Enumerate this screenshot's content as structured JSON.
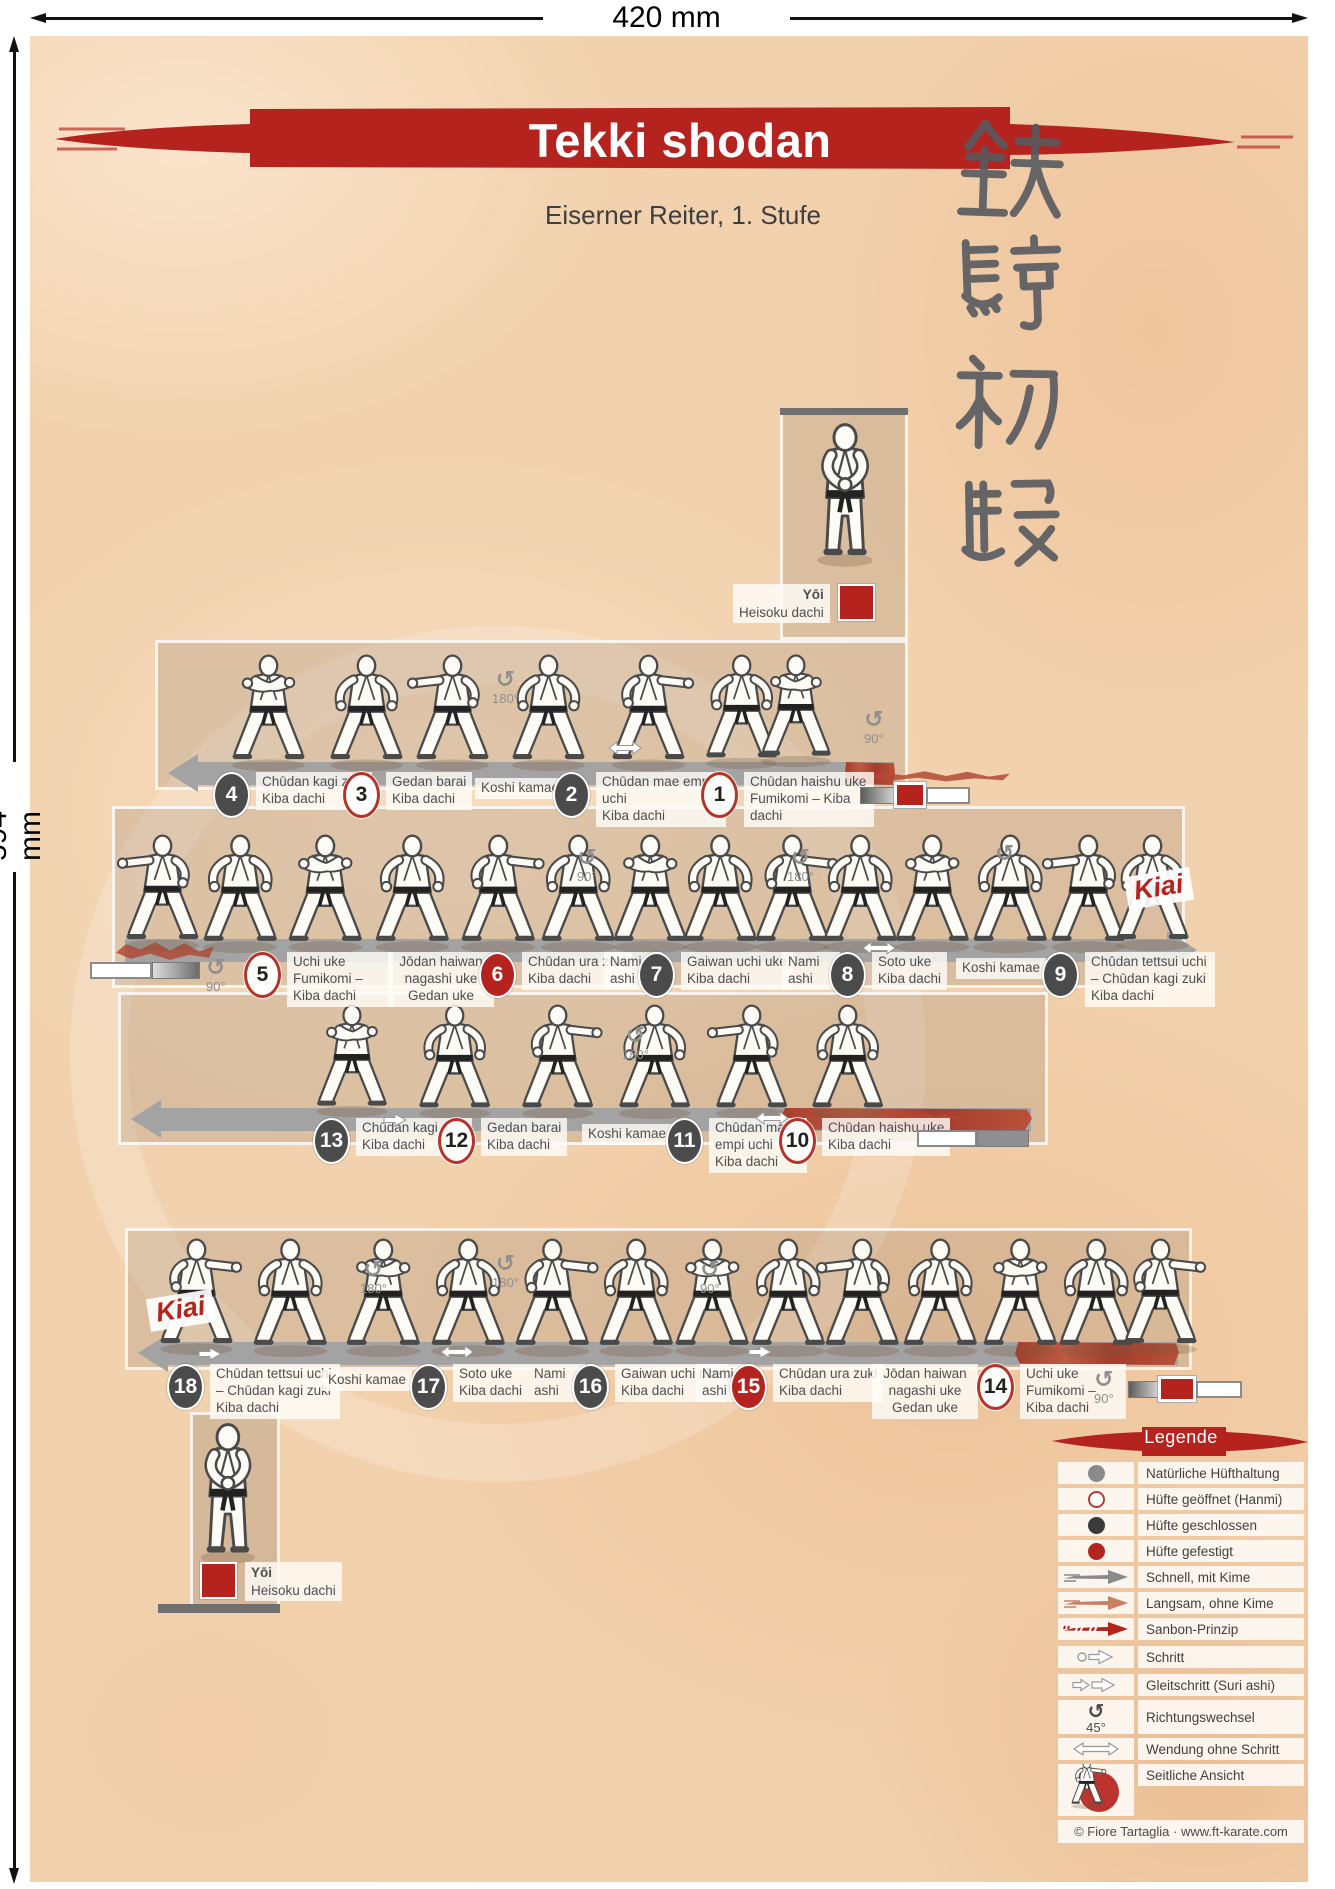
{
  "page": {
    "ruler_top": "420 mm",
    "ruler_left": "594 mm"
  },
  "header": {
    "title": "Tekki shodan",
    "subtitle": "Eiserner Reiter, 1. Stufe",
    "kanji": "鉄騎初段"
  },
  "labels": {
    "kiai": "Kiai",
    "yoi": "Yōi",
    "yoi_stance": "Heisoku dachi"
  },
  "turns": {
    "deg45": "45°",
    "deg90": "90°",
    "deg180": "180°"
  },
  "icons": {
    "rotate": "↺"
  },
  "rows": [
    {
      "name": "sequence-1",
      "steps": [
        {
          "num": "4",
          "hip": "closed",
          "name": "Chūdan kagi zuki",
          "stance": "Kiba dachi"
        },
        {
          "num": "3",
          "hip": "open",
          "name": "Gedan barai",
          "stance": "Kiba dachi"
        },
        {
          "num": "",
          "hip": "none",
          "name": "Koshi kamae",
          "stance": ""
        },
        {
          "num": "2",
          "hip": "closed",
          "name": "Chūdan mae empi uchi",
          "stance": "Kiba dachi"
        },
        {
          "num": "1",
          "hip": "open",
          "name": "Chūdan haishu uke",
          "stance": "Fumikomi – Kiba dachi"
        }
      ]
    },
    {
      "name": "sequence-2",
      "steps": [
        {
          "num": "5",
          "hip": "open",
          "name": "Uchi uke",
          "stance": "Fumikomi – Kiba dachi"
        },
        {
          "num": "",
          "hip": "none",
          "name": "Jōdan haiwan nagashi uke",
          "stance": "Gedan uke"
        },
        {
          "num": "6",
          "hip": "braced",
          "name": "Chūdan ura zuki",
          "stance": "Kiba dachi"
        },
        {
          "num": "",
          "hip": "none",
          "name": "Nami ashi",
          "stance": ""
        },
        {
          "num": "7",
          "hip": "closed",
          "name": "Gaiwan uchi uke",
          "stance": "Kiba dachi"
        },
        {
          "num": "",
          "hip": "none",
          "name": "Nami ashi",
          "stance": ""
        },
        {
          "num": "8",
          "hip": "closed",
          "name": "Soto uke",
          "stance": "Kiba dachi"
        },
        {
          "num": "",
          "hip": "none",
          "name": "Koshi kamae",
          "stance": ""
        },
        {
          "num": "9",
          "hip": "closed",
          "name": "Chūdan tettsui uchi – Chūdan kagi zuki",
          "stance": "Kiba dachi"
        }
      ]
    },
    {
      "name": "sequence-3",
      "steps": [
        {
          "num": "13",
          "hip": "closed",
          "name": "Chūdan kagi zuki",
          "stance": "Kiba dachi"
        },
        {
          "num": "12",
          "hip": "open",
          "name": "Gedan barai",
          "stance": "Kiba dachi"
        },
        {
          "num": "",
          "hip": "none",
          "name": "Koshi kamae",
          "stance": ""
        },
        {
          "num": "11",
          "hip": "closed",
          "name": "Chūdan mae empi uchi",
          "stance": "Kiba dachi"
        },
        {
          "num": "10",
          "hip": "open",
          "name": "Chūdan haishu uke",
          "stance": "Kiba dachi"
        }
      ]
    },
    {
      "name": "sequence-4",
      "steps": [
        {
          "num": "18",
          "hip": "closed",
          "name": "Chūdan tettsui uchi – Chūdan kagi zuki",
          "stance": "Kiba dachi"
        },
        {
          "num": "",
          "hip": "none",
          "name": "Koshi kamae",
          "stance": ""
        },
        {
          "num": "17",
          "hip": "closed",
          "name": "Soto uke",
          "stance": "Kiba dachi"
        },
        {
          "num": "",
          "hip": "none",
          "name": "Nami ashi",
          "stance": ""
        },
        {
          "num": "16",
          "hip": "closed",
          "name": "Gaiwan uchi uke",
          "stance": "Kiba dachi"
        },
        {
          "num": "",
          "hip": "none",
          "name": "Nami ashi",
          "stance": ""
        },
        {
          "num": "15",
          "hip": "braced",
          "name": "Chūdan ura zuki",
          "stance": "Kiba dachi"
        },
        {
          "num": "",
          "hip": "none",
          "name": "Jōdan haiwan nagashi uke",
          "stance": "Gedan uke"
        },
        {
          "num": "14",
          "hip": "open",
          "name": "Uchi uke",
          "stance": "Fumikomi – Kiba dachi"
        }
      ]
    }
  ],
  "legend": {
    "title": "Legende",
    "items": [
      {
        "icon": "hip-natural-icon",
        "label": "Natürliche Hüfthaltung"
      },
      {
        "icon": "hip-open-icon",
        "label": "Hüfte geöffnet (Hanmi)"
      },
      {
        "icon": "hip-closed-icon",
        "label": "Hüfte geschlossen"
      },
      {
        "icon": "hip-braced-icon",
        "label": "Hüfte gefestigt"
      },
      {
        "icon": "fast-arrow-icon",
        "label": "Schnell, mit Kime"
      },
      {
        "icon": "slow-arrow-icon",
        "label": "Langsam, ohne Kime"
      },
      {
        "icon": "sanbon-arrow-icon",
        "label": "Sanbon-Prinzip"
      },
      {
        "icon": "step-arrow-icon",
        "label": "Schritt"
      },
      {
        "icon": "slide-step-icon",
        "label": "Gleitschritt (Suri ashi)"
      },
      {
        "icon": "turn-icon",
        "label": "Richtungswechsel",
        "sub": "45°"
      },
      {
        "icon": "turn-no-step-icon",
        "label": "Wendung ohne Schritt"
      },
      {
        "icon": "side-view-icon",
        "label": "Seitliche Ansicht"
      }
    ],
    "copyright": "© Fiore Tartaglia · www.ft-karate.com"
  },
  "colors": {
    "accent_red": "#b5231f",
    "band_gray": "#a3a3a3",
    "dark_circle": "#4b4b4b",
    "brush_red": "#b24a36"
  }
}
